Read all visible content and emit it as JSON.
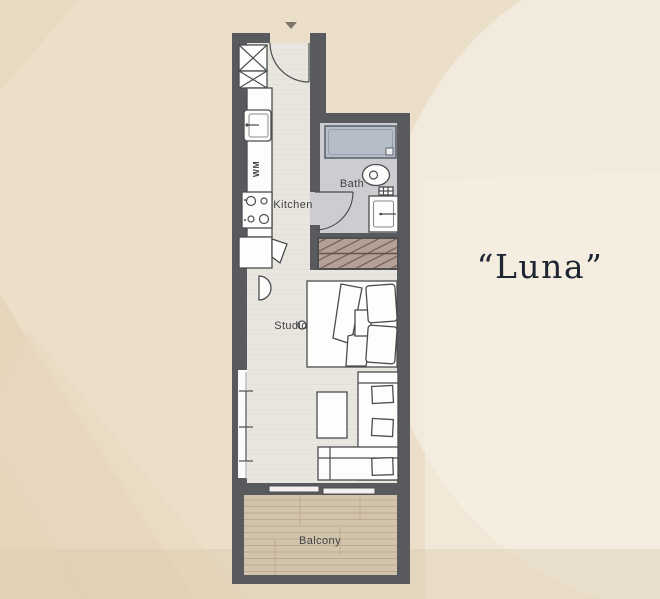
{
  "title": {
    "text": "“Luna”"
  },
  "rooms": {
    "kitchen": "Kitchen",
    "bath": "Bath",
    "studio": "Studio",
    "balcony": "Balcony"
  },
  "appliances": {
    "washing_machine": "WM"
  },
  "colors": {
    "wall": "#595a5d",
    "floor": "#e9e6e0",
    "bath_floor": "#cbcdd1",
    "tub": "#b4bdc8",
    "tub_stroke": "#60646b",
    "wardrobe_fill": "#b3a195",
    "wardrobe_stroke": "#6b4f45",
    "balcony_floor": "#d2c4ac",
    "plank_line": "#bcab90",
    "fixture_stroke": "#4b4c4f",
    "label_color": "#414244",
    "title_color": "#1c2531",
    "bg_base": "#ebdfc9",
    "bg_light": "#f2ebdd",
    "bg_lighter": "#f5efe3",
    "bg_dark": "#e1cfb1"
  }
}
